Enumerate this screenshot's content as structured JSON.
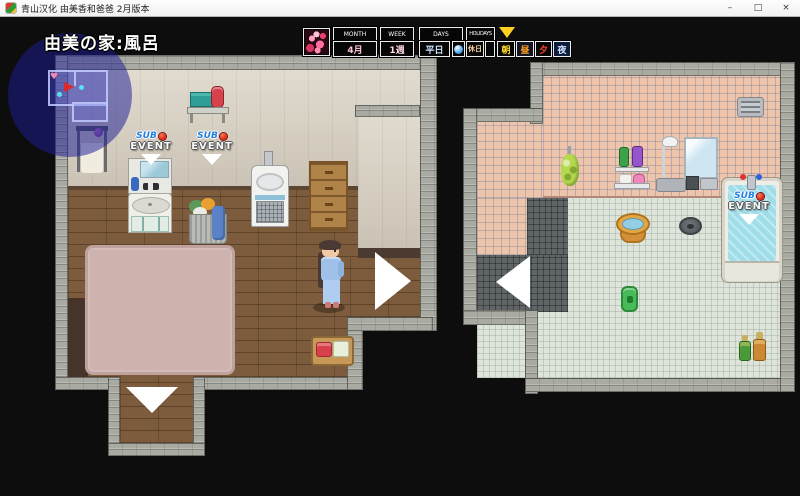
{
  "window": {
    "title": "青山汉化 由美香和爸爸 2月版本",
    "minimize": "–",
    "maximize": "□",
    "close": "×"
  },
  "location": {
    "label": "由美の家:風呂"
  },
  "hud": {
    "calendar": [
      {
        "label": "MONTH",
        "value": "4月"
      },
      {
        "label": "WEEK",
        "value": "1週"
      },
      {
        "label": "DAYS",
        "value": "平日",
        "icon": "blue-orb-icon"
      },
      {
        "label": "HOLIDAYS",
        "value": "休日",
        "icon": "empty-slot"
      }
    ],
    "time_slots": [
      {
        "label": "朝"
      },
      {
        "label": "昼"
      },
      {
        "label": "夕"
      },
      {
        "label": "夜"
      }
    ],
    "current_time": "朝",
    "calendar_icon": "cherry-blossom-calendar-art"
  },
  "sub_event": {
    "word1": "SUB",
    "word2": "EVENT"
  },
  "minimap": {
    "heart": "♥"
  },
  "colors": {
    "overlay_blue": "#1c1c94",
    "sub_blue": "#1e7fe0",
    "event_red": "#d91f10",
    "hud_yellow": "#ffd020",
    "bath_water": "#9fdde9",
    "pink_tile": "#eec4aa",
    "carpet_pink": "#cdb2ae"
  },
  "scene": {
    "left_room_objects": [
      "minimap-overlay",
      "towel-rack",
      "wall-shelf-towel",
      "red-bottle",
      "sub-event-sink",
      "sub-event-laundry",
      "mirror-cabinet",
      "sink",
      "laundry-basket",
      "urinal",
      "wooden-drawer-cabinet",
      "girl-character",
      "pink-carpet",
      "bath-tray",
      "transfer-arrow-right",
      "transfer-arrow-down"
    ],
    "right_room_objects": [
      "vent-grille",
      "loofah",
      "shampoo-shelf",
      "soap-shelf",
      "shower",
      "wall-mirror",
      "wall-faucet",
      "bathtub",
      "sub-event-bathtub",
      "wooden-bucket",
      "floor-drain",
      "green-bath-item",
      "shampoo-bottles",
      "transfer-arrow-left"
    ]
  }
}
